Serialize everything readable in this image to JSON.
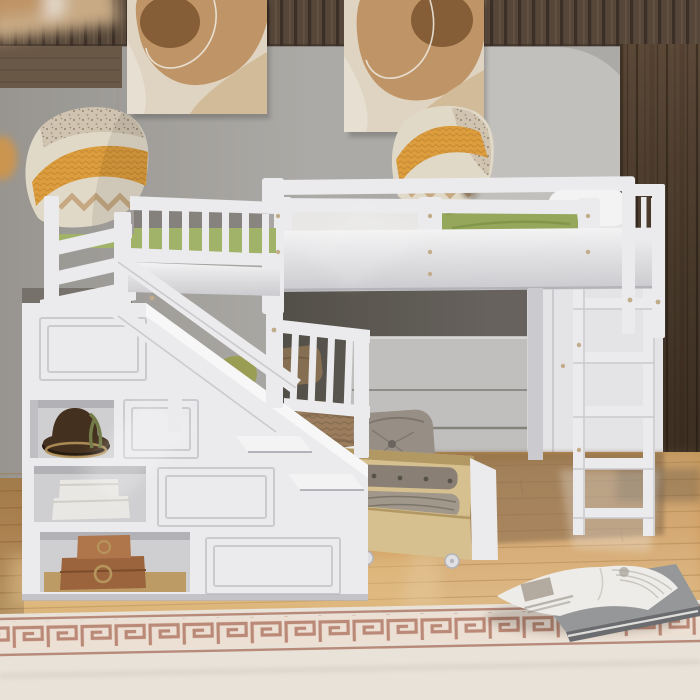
{
  "scene": {
    "description": "Product photograph of a white wooden L-shaped triple bunk loft bed with storage staircase, under-bed drawers, ladder, green bedding and patterned pillows, in a room with gray walls, wood paneling, two abstract beige wall hangings, light oak floor and a cream rug with terracotta greek-key border. An open catalog lies on the floor.",
    "objects": {
      "wall": "Gray wall with arched light panel",
      "wood_band": "Dark wood slat paneling band across top of wall",
      "wood_right": "Dark walnut wood wall panel on right",
      "art_left": "Abstract beige and caramel wall hanging (left)",
      "art_right": "Abstract beige and caramel wall hanging (right)",
      "loft_bed": "Upper loft bed with white mattress, green blanket and white pillow",
      "left_bed": "Left upper bunk with green mattress and guard rails",
      "lower_bed": "Lower twin bed with tan knit blanket, white sheet, green and brown pillows",
      "gray_pillow": "Gray tufted button pillow",
      "pillow_left": "Orange knit and speckled cream throw pillow (left bunk)",
      "pillow_right": "Orange knit and speckled cream throw pillow (loft bed)",
      "staircase": "White storage staircase with paneled side and open shelves",
      "stair_rail": "White angled stair handrails",
      "hat": "Dark brown hat with green feather on shelf",
      "boxes": "Two white storage boxes on shelf",
      "cases": "Two brown wooden keepsake cases with brass medallions",
      "drawer": "Open natural-wood under-bed drawer with folded gray clothes, on casters",
      "dresser": "Light gray under-loft dresser",
      "cabinet": "White under-loft wardrobe cabinet",
      "ladder": "White vertical ladder to loft bed",
      "floor": "Light oak plank floor with reflections",
      "rug": "Cream rug with terracotta greek-key border band",
      "book": "Open furniture catalog with blurred illegible text, lying on a closed gray book"
    }
  },
  "palette": {
    "wall": "#b2b0ac",
    "wall_dark": "#9d9a95",
    "arch": "#c9c7c3",
    "wood_band": "#594a3c",
    "wood_band_dark": "#3d3128",
    "wood_band_light": "#6e5b49",
    "wood_right": "#5e4b39",
    "wood_right_dark": "#453523",
    "wood_right_line": "#31261b",
    "tap_bg": "#e7dbc9",
    "tap_caramel": "#c69a6b",
    "tap_brown": "#8a6138",
    "tap_cream": "#eee7d9",
    "tap_sand": "#d9c29e",
    "tap_line": "#f4efe6",
    "frame_white": "#f3f3f5",
    "frame_light": "#fbfbfc",
    "frame_shadow": "#d2d2d6",
    "frame_dark": "#b9b9bf",
    "screw": "#c9b28f",
    "mattress": "#f0efed",
    "mattress_shadow": "#d9d7d2",
    "green_light": "#b4c47c",
    "green_mid": "#9aad5d",
    "green_dark": "#7d9246",
    "green_mattress": "#a6b96d",
    "pillow_cream": "#e9e0cf",
    "pillow_speck": "#d7cab6",
    "pillow_orange": "#e3a33f",
    "pillow_orange_dark": "#bf7f2c",
    "pillow_dot": "#5c5144",
    "pillow_tan": "#c5a276",
    "brown_pillow": "#8a7254",
    "green_pillow": "#9fa457",
    "blanket_tan": "#a08261",
    "blanket_tan_dark": "#7d6448",
    "sheet_white": "#f4f2ee",
    "gray_pillow": "#9c938a",
    "gray_pillow_dark": "#6f6760",
    "under_dark": "#6b6660",
    "under_dark2": "#55514b",
    "under_panel": "#c7c6c4",
    "cabinet_white": "#ececee",
    "drawer_wood": "#ddc794",
    "drawer_wood_dark": "#b89d66",
    "clothes_a": "#8e8479",
    "clothes_b": "#a79d90",
    "clothes_dark": "#5a554d",
    "hat": "#46321f",
    "hat_dark": "#2a1d12",
    "feather": "#77804b",
    "box_white": "#f1efeb",
    "box_shadow": "#d8d5cf",
    "case_top": "#b5794e",
    "case_bottom": "#a0683f",
    "brass": "#bb9a5e",
    "floor_base": "#d7a364",
    "floor_light": "#eccb92",
    "floor_dark": "#b5834a",
    "floor_shadow": "#6f5130",
    "plank_line": "#a97b3f",
    "rug_cream": "#f0eae0",
    "rug_band": "#c28e7b",
    "rug_band_dark": "#b57f6c",
    "rug_band_bg": "#f4e7da",
    "book_page": "#f6f4f0",
    "book_cover": "#9a9c9e",
    "book_cover_dark": "#6e7073",
    "book_text": "#8f8a82"
  }
}
